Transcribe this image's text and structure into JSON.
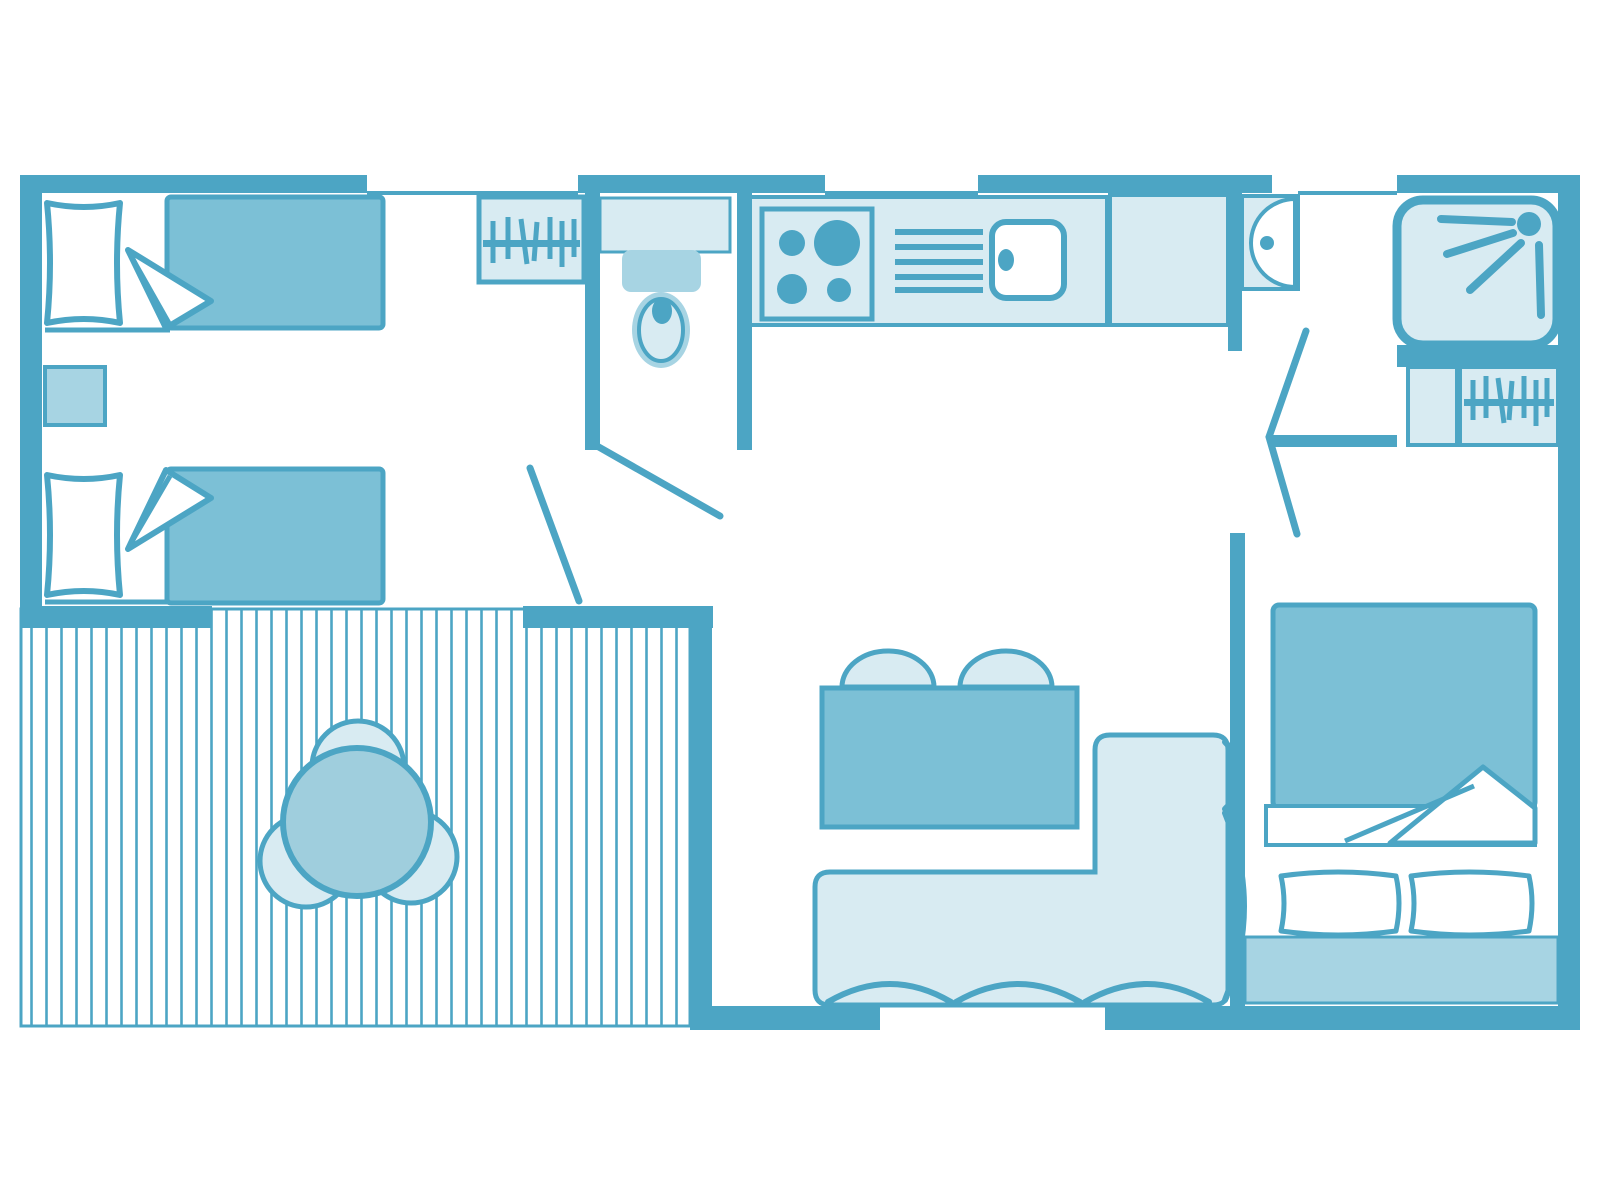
{
  "colors": {
    "wall": "#4CA5C4",
    "bed": "#7CC0D6",
    "mid": "#A7D4E3",
    "light": "#D8EBF2",
    "round_table": "#9FCEDD",
    "background": "#FFFFFF"
  },
  "fixtures": {
    "twin_bedroom": [
      "single-bed",
      "single-bed",
      "nightstand",
      "wardrobe-hanger-rail"
    ],
    "wc": [
      "toilet"
    ],
    "kitchen": [
      "hob-4-burners",
      "drainer",
      "sink",
      "counter"
    ],
    "entry": [
      "washbasin",
      "bifold-door"
    ],
    "shower_room": [
      "shower-tray",
      "shower-head",
      "hanger-closet"
    ],
    "master_bedroom": [
      "double-bed",
      "pillow",
      "pillow",
      "headboard"
    ],
    "living_room": [
      "dining-table",
      "chair",
      "chair",
      "corner-sofa"
    ],
    "terrace": [
      "decking",
      "round-table",
      "chair",
      "chair",
      "chair"
    ]
  }
}
